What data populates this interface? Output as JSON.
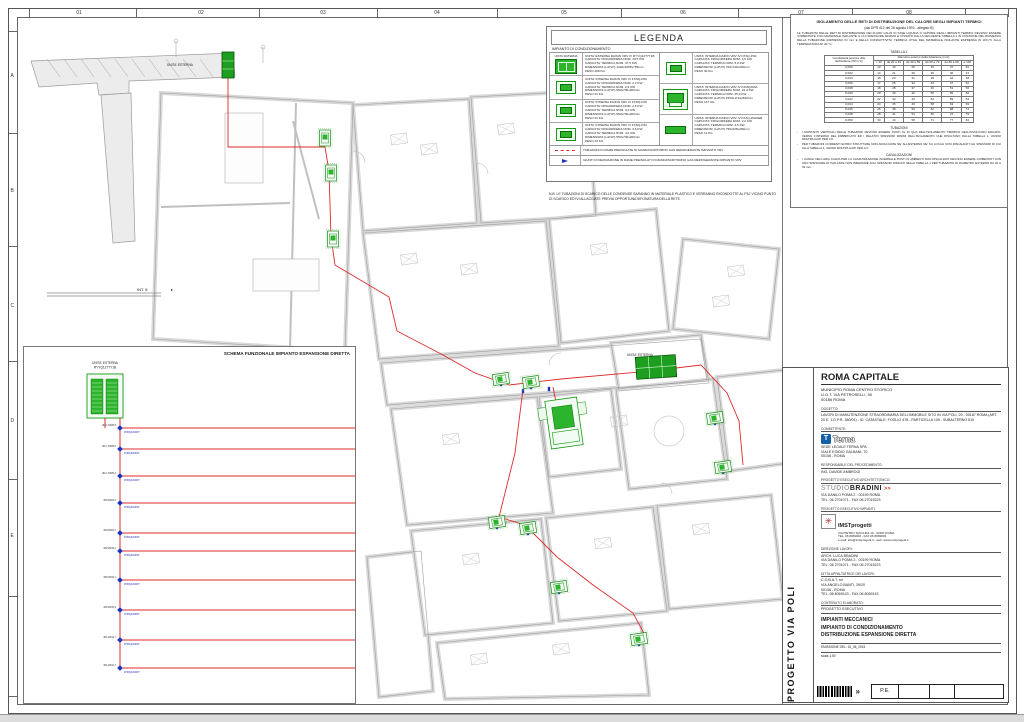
{
  "sheet": {
    "ruler_numbers": [
      {
        "label": "01",
        "x": 78
      },
      {
        "label": "02",
        "x": 200
      },
      {
        "label": "03",
        "x": 322
      },
      {
        "label": "04",
        "x": 436
      },
      {
        "label": "05",
        "x": 563
      },
      {
        "label": "06",
        "x": 682
      },
      {
        "label": "07",
        "x": 800
      },
      {
        "label": "08",
        "x": 908
      }
    ],
    "row_letters": [
      {
        "label": "A",
        "y": 75
      },
      {
        "label": "B",
        "y": 190
      },
      {
        "label": "C",
        "y": 305
      },
      {
        "label": "D",
        "y": 420
      },
      {
        "label": "E",
        "y": 535
      }
    ]
  },
  "legend": {
    "title": "LEGENDA",
    "subtitle": "IMPIANTO DI CONDIZIONAMENTO",
    "items": [
      {
        "icon": "outdoor",
        "icon_label": "UNITA' ESTERNA",
        "lines": [
          "UNITA' ESTERNA DAIKIN VRV IV RYYQ12T7Y1B",
          "CAPACITA' FRIGORIFERA NOM. 33,5 KW",
          "CAPACITA' TERMICA NOM. 37,5 KW",
          "DIMENSIONI (LxPxH) 1240x1685x765mm",
          "PESO 268 KG"
        ]
      },
      {
        "icon": "fxsq",
        "icon_label": "FXSQ20",
        "lines": [
          "UNITA' INTERNA DAIKIN VRV IV FXSQ-P20",
          "CAPACITA' FRIGORIFERA NOM. 2,2 KW",
          "CAPACITA' TERMICA NOM. 2,5 KW",
          "DIMENSIONI (LxPxH) 550x700x200mm",
          "PESO 21 KG"
        ]
      },
      {
        "icon": "fxsq",
        "icon_label": "FXSQ25",
        "lines": [
          "UNITA' INTERNA DAIKIN VRV IV FXSQ-P25",
          "CAPACITA' FRIGORIFERA NOM. 2,8 KW",
          "CAPACITA' TERMICA NOM. 3,2 KW",
          "DIMENSIONI (LxPxH) 550x700x200mm",
          "PESO 21 KG"
        ]
      },
      {
        "icon": "fxsq",
        "icon_label": "FXSQ32",
        "lines": [
          "UNITA' INTERNA DAIKIN VRV IV FXSQ-P32",
          "CAPACITA' FRIGORIFERA NOM. 3,6 KW",
          "CAPACITA' TERMICA NOM. 4,0 KW",
          "DIMENSIONI (LxPxH) 550x700x200mm",
          "PESO 23 KG"
        ]
      },
      {
        "icon": "fxsq",
        "icon_label": "FXSQ40",
        "lines": [
          "UNITA' INTERNA DAIKIN VRV IV FXSQ-P40",
          "CAPACITA' FRIGORIFERA NOM. 4,5 KW",
          "CAPACITA' TERMICA NOM. 5,0 KW",
          "DIMENSIONI (LxPxH) 700x740x200mm",
          "PESO 30 KG"
        ]
      },
      {
        "icon": "fxmq",
        "icon_label": "FXMQ200",
        "lines": [
          "UNITA' INTERNA DAIKIN VRV IV FXMQ200A",
          "CAPACITA' FRIGORIFERA NOM. 22,4 KW",
          "CAPACITA' TERMICA NOM. 25,0 KW",
          "DIMENSIONI (LxPxH) 1594x1714x840mm",
          "PESO 137 KG"
        ]
      },
      {
        "icon": "fxaq",
        "icon_label": "FXAQ20",
        "lines": [
          "UNITA' INTERNA DAIKIN VRV IV FXAQ-20AVEB",
          "CAPACITA' FRIGORIFERA NOM. 2,2 KW",
          "CAPACITA' TERMICA NOM. 2,5 KW",
          "DIMENSIONI (LxPxH) 795x228x290mm",
          "PESO 11 KG"
        ]
      }
    ],
    "line_items": [
      {
        "symbol": "red-dashed-line",
        "text": "TUBAZIONI IN RAME PREISOLATE DI MANDATA/RITORNO GAS REFRIGERANTE IMPIANTO VRV"
      },
      {
        "symbol": "blue-joint",
        "text": "GIUNTI DI DERIVAZIONE IN RAME PREISOLATI DI MANDATA/RITORNO GAS REFRIGERANTE IMPIANTO VRV"
      }
    ],
    "note": "N.B. LE TUBAZIONI DI SCARICO DELLE CONDENSE SARANNO IN MATERIALE PLASTICO E VERRANNO RICONDOTTE AL PIU' VICINO PUNTO DI SCARICO ED IVI ALLACCIATE PREVIA OPPORTUNA SIFONATURA DELLA RETE"
  },
  "spec_panel": {
    "title": "ISOLAMENTO DELLE RETI DI DISTRIBUZIONE DEL CALORE NEGLI IMPIANTI TERMICI",
    "subtitle": "(dal DPR 412 del 26 agosto 1993  -  allegato B)",
    "intro": "LE TUBAZIONI DELLE RETI DI DISTRIBUZIONE DEI FLUIDI CALDI IN FASE LIQUIDA O VAPORE DEGLI IMPIANTI TERMICI DEVONO ESSERE COIBENTATE CON MATERIALE ISOLANTE IL CUI SPESSORE MINIMO E' FISSATO DALLA SEGUENTE TABELLA 1 IN FUNZIONE DEL DIAMETRO DELLA TUBAZIONE ESPRESSO IN mm E DELLA CONDUTTIVITA' TERMICA UTILE DEL MATERIALE ISOLANTE ESPRESSA IN W/m°C ALLA TEMPERATURA DI 40 °C.",
    "table_title": "TABELLA 1",
    "table": {
      "row_header": "Conduttività termica utile dell'isolante (W/m°C)",
      "col_header": "Diametro esterno della tubazione (mm)",
      "columns": [
        "< 20",
        "da 20 a 39",
        "da 40 a 59",
        "da 60 a 79",
        "da 80 a 99",
        "≥ 100"
      ],
      "rows": [
        {
          "c": "0,030",
          "v": [
            13,
            19,
            26,
            33,
            37,
            40
          ]
        },
        {
          "c": "0,032",
          "v": [
            14,
            21,
            29,
            36,
            40,
            44
          ]
        },
        {
          "c": "0,034",
          "v": [
            15,
            23,
            31,
            39,
            44,
            48
          ]
        },
        {
          "c": "0,036",
          "v": [
            17,
            25,
            34,
            43,
            47,
            52
          ]
        },
        {
          "c": "0,038",
          "v": [
            18,
            28,
            37,
            46,
            51,
            56
          ]
        },
        {
          "c": "0,040",
          "v": [
            20,
            30,
            40,
            50,
            55,
            60
          ]
        },
        {
          "c": "0,042",
          "v": [
            22,
            32,
            43,
            54,
            59,
            64
          ]
        },
        {
          "c": "0,044",
          "v": [
            24,
            35,
            46,
            58,
            63,
            69
          ]
        },
        {
          "c": "0,046",
          "v": [
            26,
            38,
            50,
            62,
            68,
            74
          ]
        },
        {
          "c": "0,048",
          "v": [
            28,
            41,
            54,
            66,
            72,
            79
          ]
        },
        {
          "c": "0,050",
          "v": [
            30,
            44,
            58,
            71,
            77,
            84
          ]
        }
      ]
    },
    "notes_title": "TUBAZIONI",
    "notes": [
      "I MONTANTI VERTICALI DELLE TUBAZIONI DEVONO ESSERE POSTI AL DI QUA DELL'ISOLAMENTO TERMICO DELL'INVOLUCRO EDILIZIO, VERSO L'INTERNO DEL FABBRICATO ED I RELATIVI SPESSORI MINIMI DELL'ISOLAMENTO CHE RISULTANO DALLA TABELLA 1, VANNO MOLTIPLICATI PER 0,5.",
      "PER TUBAZIONI CORRENTI ENTRO STRUTTURE NON AFFACCIATE NE' ALL'ESTERNO NE' SU LOCALI NON RISCALDATI GLI SPESSORI DI CUI ALLA TABELLA 1, VANNO MOLTIPLICATI PER 0,3."
    ],
    "canal_title": "CANALIZZAZIONI",
    "canal_notes": [
      "I CANALI DELL'ARIA CALDA PER LA CLIMATIZZAZIONE INVERNALE POSTI IN AMBIENTI NON RISCALDATI DEVONO ESSERE COIBENTATI CON UNO SPESSORE DI ISOLANTE NON INFERIORE AGLI SPESSORI INDICATI NELLA TABELLA 1 PER TUBAZIONI DI DIAMETRO ESTERNO DA 20 A 39 mm."
    ]
  },
  "title_block": {
    "client": "ROMA CAPITALE",
    "client_lines": [
      "MUNICIPIO ROMA CENTRO STORICO",
      "U.O.T. VIA PETROSELLI, 50",
      "00186 ROMA"
    ],
    "oggetto_label": "OGGETTO:",
    "oggetto": "LAVORI DI MANUTENZIONE STRAORDINARIA DELL'IMMOBILE SITO IN VIA POLI, 29 - 00187 ROMA (ART. 20 E. 1 D.P.R. 380/01) - ID. CATASTALE: FOGLIO 478 - PARTICELLA 105 - SUBALTERNO 510",
    "committente_label": "COMMITTENTE:",
    "terna_word": "Terna",
    "terna_lines": [
      "SEDE LEGALE TERNA SPA",
      "VIALE EGIDIO GALBANI, 70",
      "00156 - ROMA"
    ],
    "resp_label": "RESPONSABILE DEL PROCEDIMENTO:",
    "resp": "ING. DAVIDE AMBROGI",
    "arch_label": "PROGETTO ESECUTIVO ARCHITETTONICO:",
    "studio_1": "STUDIO",
    "studio_2": "BRADINI",
    "studio_3": ">>",
    "studio_lines": [
      "VIA DANILO POMA 2 - 00199 ROMA",
      "TEL. 06 2701071 - FAX 06 27019223"
    ],
    "imp_label": "PROGETTO ESECUTIVO IMPIANTI:",
    "imst_name": "IMSTprogetti",
    "imst_lines": [
      "VIA PIETRO TACCHINI 19 - 00197 ROMA",
      "TEL. 06 8069002 - FAX 06 8069003",
      "e-mail: info@imstprogetti.it - web: www.imstprogetti.it"
    ],
    "dl_label": "DIREZIONE LAVORI:",
    "dl_lines": [
      "ARCH. LUCA BRADINI",
      "VIA DANILO POMA 2 - 00199 ROMA",
      "TEL. 06 2701071 - FAX 06 27019223"
    ],
    "ditta_label": "DITTA APPALTATRICE DEI LAVORI:",
    "ditta_lines": [
      "C.O.B.A.T. srl",
      "VIA ANGELO BANTI, 39/20",
      "00136 - ROMA",
      "TEL. 06 8069143 - FAX 06 8069143"
    ],
    "contenuto_label": "CONTENUTO ELABORATO:",
    "prog_esec": "PROGETTO ESECUTIVO",
    "content_lines": [
      "IMPIANTI MECCANICI",
      "IMPIANTO DI CONDIZIONAMENTO",
      "DISTRIBUZIONE ESPANSIONE DIRETTA"
    ],
    "emissione": "EMISSIONE DEL: 15_06_2015",
    "scala": "scala 1:50",
    "pe": "P.E.",
    "vertical_title": "PROGETTO  VIA POLI"
  },
  "schema": {
    "title": "SCHEMA FUNZIONALE IMPIANTO ESPANSIONE DIRETTA",
    "outdoor_label": "UNITA' ESTERNA",
    "outdoor_model": "RYYQ12T7Y1B",
    "joint": "KHRQ22M20T",
    "trunk": {
      "x": 118,
      "y1": 416,
      "y2": 666
    },
    "units": [
      {
        "name": "02-SEGRETERIA",
        "model": "FXSQ25P",
        "pipe": "Ø6,4/Ø12,7",
        "tp": "Ø12,7/Ø28,6",
        "pts": "118,426 592,426 660,426",
        "x": 660,
        "y": 418
      },
      {
        "name": "03-UFFICIO RAGIONERIA",
        "model": "FXSQ25P",
        "pipe": "Ø6,4/Ø12,7",
        "tp": "",
        "pts": "592,426 592,468 660,468",
        "x": 660,
        "y": 460
      },
      {
        "name": "01-UFFICIO PRESIDENZA",
        "model": "FXSQ40P",
        "pipe": "Ø6,4/Ø12,7",
        "tp": "Ø12,7/Ø28,6",
        "pts": "118,447 448,447",
        "x": 448,
        "y": 439
      },
      {
        "name": "04-SALA RIUNIONI P.T.",
        "model": "FXSQ25P",
        "pipe": "Ø6,4/Ø12,7",
        "tp": "Ø12,7/Ø25,4",
        "pts": "118,474 448,474",
        "x": 448,
        "y": 466
      },
      {
        "name": "05-SALA FOTOCOPIE/SPED. POSTA",
        "model": "FXMQ200A",
        "pipe": "Ø9,5/Ø22,2",
        "tp": "Ø9,5/Ø22,2",
        "pts": "118,501 448,501",
        "x": 448,
        "y": 493,
        "t": "big"
      },
      {
        "name": "06-SALA RIUNIONI P.1",
        "model": "FXSQ32P",
        "pipe": "Ø6,4/Ø12,7",
        "tp": "Ø9,5/Ø22,2",
        "pts": "118,531 592,531 660,531",
        "x": 660,
        "y": 523
      },
      {
        "name": "07-SALA BIBLIOTECA",
        "model": "FXSQ25P",
        "pipe": "Ø6,4/Ø12,7",
        "tp": "",
        "pts": "592,531 592,573 660,573",
        "x": 660,
        "y": 565
      },
      {
        "name": "08-UFFICIO 1",
        "model": "FXSQ25P",
        "pipe": "Ø6,4/Ø12,7",
        "tp": "Ø9,5/Ø19,1",
        "pts": "118,549 448,549",
        "x": 448,
        "y": 541
      },
      {
        "name": "09-ARCHIVIO/ATTESA",
        "model": "FXSQ25P",
        "pipe": "Ø6,4/Ø12,7",
        "tp": "Ø9,5/Ø19,1",
        "pts": "118,578 448,578",
        "x": 448,
        "y": 570
      },
      {
        "name": "10-UFFICI SEGRETERIA",
        "model": "FXSQ25P",
        "pipe": "Ø6,4/Ø12,7",
        "tp": "Ø9,5/Ø15,9",
        "pts": "118,608 448,608",
        "x": 448,
        "y": 600
      },
      {
        "name": "11-SALA RIUNIONI P.2",
        "model": "FXSQ25P",
        "pipe": "Ø6,4/Ø12,7",
        "tp": "Ø6,4/Ø12,7",
        "pts": "118,638 448,638",
        "x": 448,
        "y": 630
      },
      {
        "name": "12-IMPIANTI PIANO RIALZATO",
        "model": "FXAQ20AVEB",
        "pipe": "Ø6,4/Ø12,7",
        "tp": "Ø6,4/Ø12,7",
        "pts": "118,666 448,666",
        "x": 448,
        "y": 660,
        "t": "flat"
      }
    ]
  },
  "plan": {
    "labels": {
      "ext1": "UNITA' ESTERNA",
      "ext2": "UNITA' ESTERNA",
      "int8": "INT. 8"
    },
    "units": [
      {
        "t": "fxsq",
        "x": 324,
        "y": 137,
        "a": 90
      },
      {
        "t": "fxsq",
        "x": 330,
        "y": 172,
        "a": 90
      },
      {
        "t": "fxsq",
        "x": 332,
        "y": 238,
        "a": 90
      },
      {
        "t": "fxsq",
        "x": 500,
        "y": 378,
        "a": -8
      },
      {
        "t": "fxsq",
        "x": 530,
        "y": 381,
        "a": -8
      },
      {
        "t": "fxsq",
        "x": 714,
        "y": 417,
        "a": -8
      },
      {
        "t": "fxsq",
        "x": 722,
        "y": 466,
        "a": -8
      },
      {
        "t": "fxsq",
        "x": 496,
        "y": 521,
        "a": -8
      },
      {
        "t": "fxsq",
        "x": 527,
        "y": 527,
        "a": -8
      },
      {
        "t": "fxsq",
        "x": 558,
        "y": 586,
        "a": -8
      },
      {
        "t": "fxsq",
        "x": 638,
        "y": 638,
        "a": -8
      },
      {
        "t": "ext-s",
        "x": 227,
        "y": 64,
        "a": 0
      },
      {
        "t": "ext-l",
        "x": 655,
        "y": 366,
        "a": -4
      },
      {
        "t": "fxmq",
        "x": 563,
        "y": 422,
        "a": -8
      }
    ]
  },
  "colors": {
    "unit_green": "#2cb52c",
    "unit_green_dark": "#0c6d0c",
    "pipe_red": "#dd2b2b",
    "joint_blue": "#2233bb",
    "wall_gray": "#d9d9d9",
    "terna_blue": "#1560a8"
  }
}
